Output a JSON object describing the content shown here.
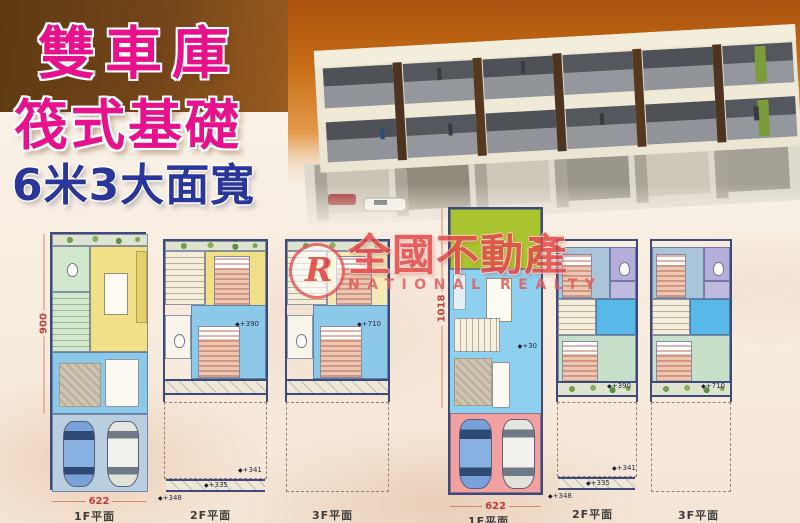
{
  "titles": {
    "line1": "雙車庫",
    "line2": "筏式基礎",
    "line3": "6米3大面寬"
  },
  "watermark": {
    "logo_letter": "R",
    "brand": "全國不動產",
    "brand_en": "NATIONAL REALTY"
  },
  "colors": {
    "title_pink": "#e8118c",
    "title_navy": "#2a3699",
    "brown_block": "#74451a",
    "sky_orange": "#c76c16",
    "dim_red": "#c43b3b",
    "plan_wall": "#3d4a7a",
    "yellow_room": "#f2e088",
    "blue_room": "#8cc8e8",
    "green_room": "#d2e8cc",
    "garage_blue": "#b9cede",
    "garage_pink": "#f2a0a0",
    "yard_green": "#a9c42e",
    "hall_blue": "#58b8e8",
    "bath_purple": "#b6aeda",
    "bedroom_bluegray": "#aac4da",
    "bedroom_green": "#c6e0ca"
  },
  "plans": {
    "left_f1": {
      "label": "1F平面",
      "width_dim": "622",
      "height_dim": "900"
    },
    "left_f2": {
      "label": "2F平面",
      "level": "+390",
      "a1": "+341",
      "a2": "+335",
      "a3": "+348"
    },
    "left_f3": {
      "label": "3F平面",
      "level": "+710"
    },
    "right_f1": {
      "label": "1F平面",
      "width_dim": "622",
      "height_dim": "1018",
      "level": "+30"
    },
    "right_f2": {
      "label": "2F平面",
      "level": "+390",
      "a1": "+341",
      "a2": "+335",
      "a3": "+348"
    },
    "right_f3": {
      "label": "3F平面",
      "level": "+710"
    }
  }
}
